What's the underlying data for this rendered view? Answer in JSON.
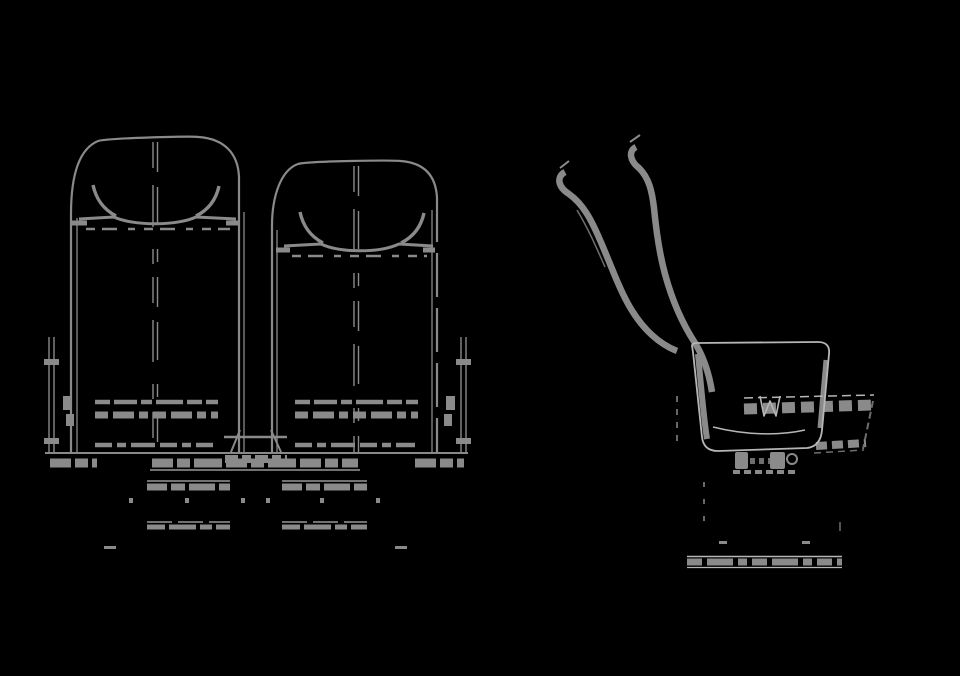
{
  "colors": {
    "background": "#000000",
    "line_main": "#8a8a8a",
    "line_light": "#b6b6b6",
    "line_dim": "#6e6e6e"
  },
  "figure": {
    "type": "technical-line-drawing",
    "subject": "twin passenger seat assembly, wireframe on black",
    "views": [
      {
        "name": "front-elevation",
        "parts": [
          "left-seatback",
          "right-seatback",
          "headrest-handle-arcs",
          "headrest-bar",
          "center-seam",
          "stitch-bands",
          "side-panels",
          "base-rail",
          "pedestal-rails",
          "floor-feet"
        ]
      },
      {
        "name": "side-elevation",
        "parts": [
          "backrest-rear-band",
          "backrest-front-band",
          "seat-pan",
          "cushion-crease",
          "hidden-armrest-dashed",
          "recline-mechanism",
          "floor-rail",
          "rail-clamps"
        ]
      }
    ]
  }
}
